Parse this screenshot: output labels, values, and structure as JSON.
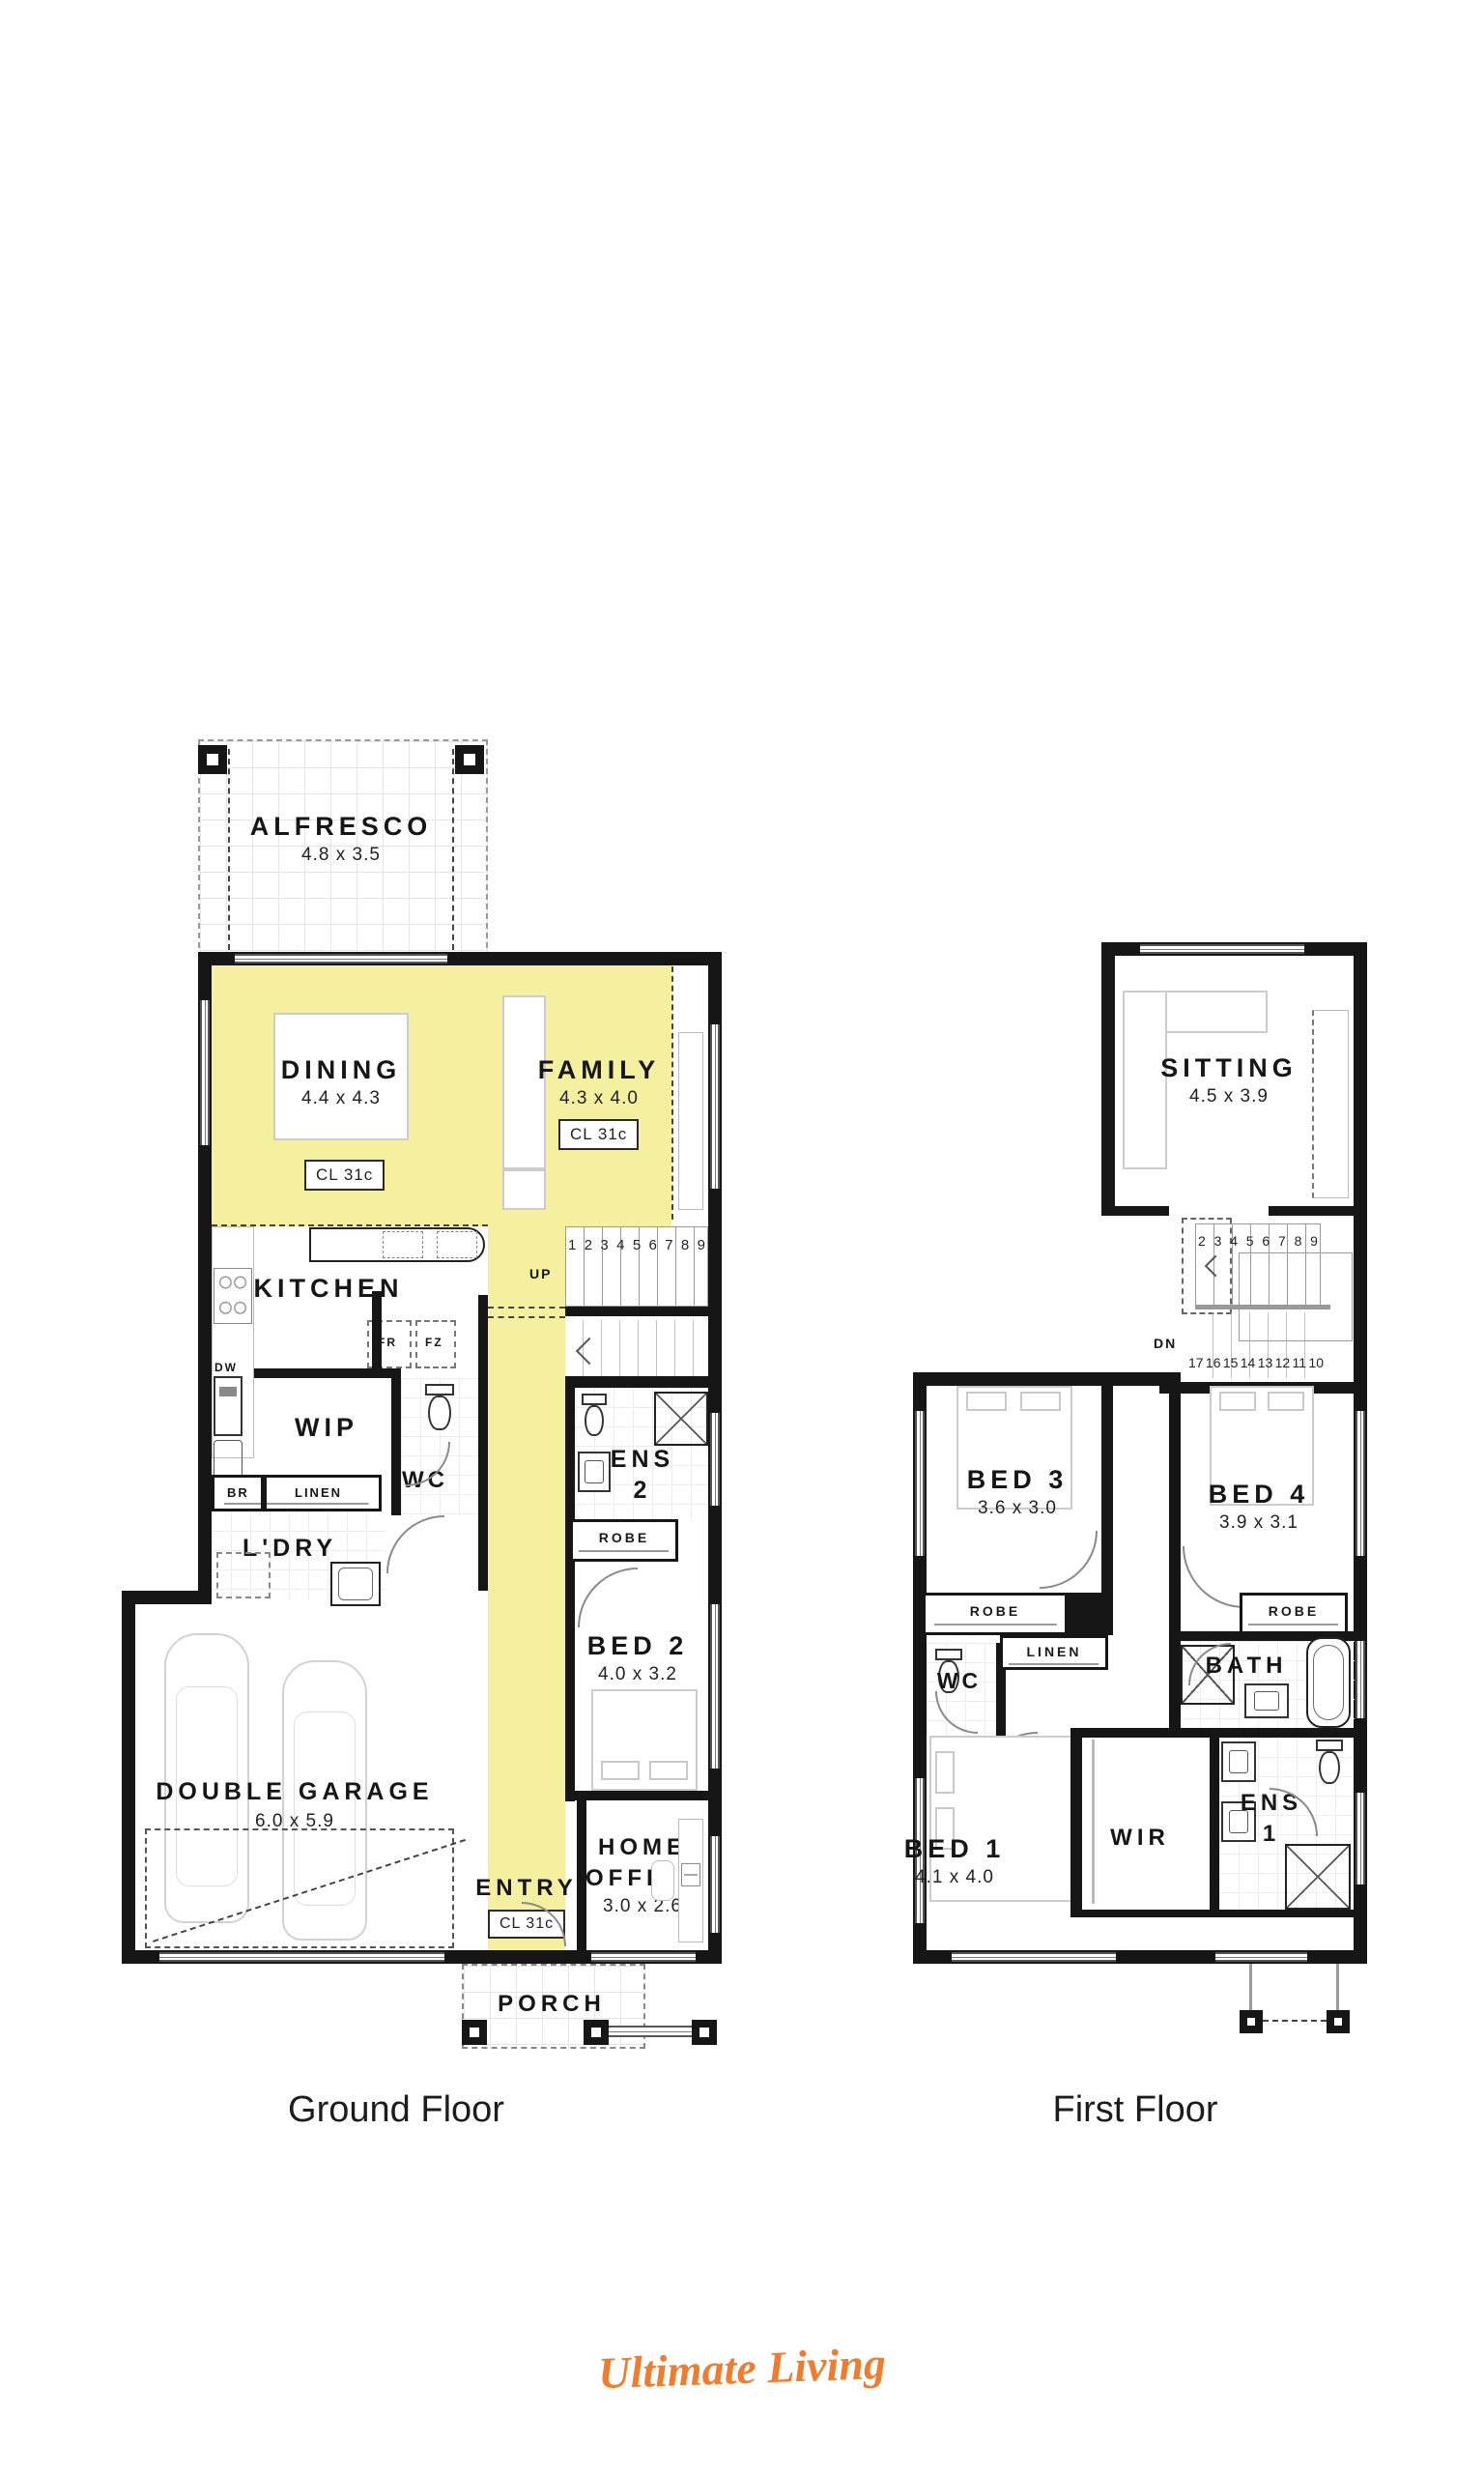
{
  "colors": {
    "highlight": "#F5EFA0",
    "wall": "#161616",
    "logo_orange": "#EF7D2E"
  },
  "gf": {
    "caption": "Ground Floor",
    "alfresco": {
      "name": "ALFRESCO",
      "dims": "4.8 x 3.5"
    },
    "dining": {
      "name": "DINING",
      "dims": "4.4 x 4.3",
      "cl": "CL 31c"
    },
    "family": {
      "name": "FAMILY",
      "dims": "4.3 x 4.0",
      "cl": "CL 31c"
    },
    "kitchen": {
      "name": "KITCHEN"
    },
    "appliances": {
      "dw": "DW",
      "fr": "FR",
      "fz": "FZ"
    },
    "stairs": {
      "up": "UP",
      "numbers": [
        "1",
        "2",
        "3",
        "4",
        "5",
        "6",
        "7",
        "8",
        "9"
      ]
    },
    "wip": {
      "name": "WIP"
    },
    "wc": {
      "name": "WC"
    },
    "ens2": {
      "line1": "ENS",
      "line2": "2"
    },
    "robe": {
      "name": "ROBE"
    },
    "bed2": {
      "name": "BED 2",
      "dims": "4.0 x 3.2"
    },
    "br": {
      "name": "BR"
    },
    "linen": {
      "name": "LINEN"
    },
    "ldry": {
      "name": "L'DRY"
    },
    "garage": {
      "name": "DOUBLE GARAGE",
      "dims": "6.0 x 5.9"
    },
    "entry": {
      "name": "ENTRY",
      "cl": "CL 31c"
    },
    "office": {
      "line1": "HOME",
      "line2": "OFFICE",
      "dims": "3.0 x 2.6"
    },
    "porch": {
      "name": "PORCH"
    }
  },
  "ff": {
    "caption": "First Floor",
    "sitting": {
      "name": "SITTING",
      "dims": "4.5 x 3.9"
    },
    "stairs": {
      "dn": "DN",
      "top": [
        "2",
        "3",
        "4",
        "5",
        "6",
        "7",
        "8",
        "9"
      ],
      "bottom": [
        "17",
        "16",
        "15",
        "14",
        "13",
        "12",
        "11",
        "10"
      ]
    },
    "bed3": {
      "name": "BED 3",
      "dims": "3.6 x 3.0"
    },
    "bed4": {
      "name": "BED 4",
      "dims": "3.9 x 3.1"
    },
    "robe3": {
      "name": "ROBE"
    },
    "robe4": {
      "name": "ROBE"
    },
    "wc": {
      "name": "WC"
    },
    "linen": {
      "name": "LINEN"
    },
    "bath": {
      "name": "BATH"
    },
    "bed1": {
      "name": "BED 1",
      "dims": "4.1 x 4.0"
    },
    "wir": {
      "name": "WIR"
    },
    "ens1": {
      "line1": "ENS",
      "line2": "1"
    }
  },
  "logo": {
    "text": "Ultimate Living"
  }
}
